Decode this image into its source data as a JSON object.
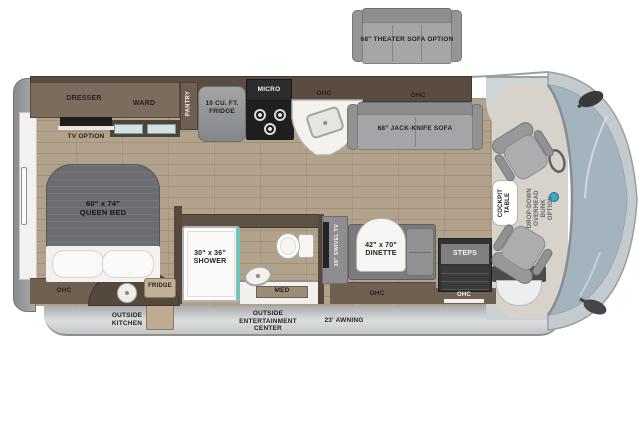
{
  "labels": {
    "theater_sofa": "68\" THEATER SOFA OPTION",
    "dresser": "DRESSER",
    "ward": "WARD",
    "pantry": "PANTRY",
    "tv_option": "TV OPTION",
    "kitchen_fridge": "10 CU. FT.\nFRIDGE",
    "micro": "MICRO",
    "ohc_kitchen": "OHC",
    "ohc_sofa": "OHC",
    "jack_knife_sofa": "68\" JACK-KNIFE SOFA",
    "queen_bed": "60\" x 74\"\nQUEEN BED",
    "ohc_bedroom": "OHC",
    "ohc_outside_kitchen": "OHC",
    "outside_fridge": "FRIDGE",
    "shower": "30\" x 36\"\nSHOWER",
    "med": "MED",
    "swivel_tv": "39\" SWIVEL TV",
    "dinette": "42\" x 70\"\nDINETTE",
    "ohc_dinette": "OHC",
    "steps": "STEPS",
    "ohc_entry": "OHC",
    "cockpit_table": "COCKPIT\nTABLE",
    "overhead_bunk": "DROP-DOWN\nOVERHEAD BUNK\nOPTION",
    "outside_kitchen": "OUTSIDE\nKITCHEN",
    "outside_entertainment": "OUTSIDE\nENTERTAINMENT\nCENTER",
    "awning": "23' AWNING"
  },
  "colors": {
    "wood_floor": "#b3a28b",
    "wall_dark": "#5a4c40",
    "cabinet": "#7c6c5d",
    "furniture_gray": "#a5a5a7",
    "shower_glass_teal": "#74c4be",
    "windshield_glass": "#a4b4be",
    "front_cap": "#c4cacd",
    "skirt_gray": "#c3c5c7"
  }
}
